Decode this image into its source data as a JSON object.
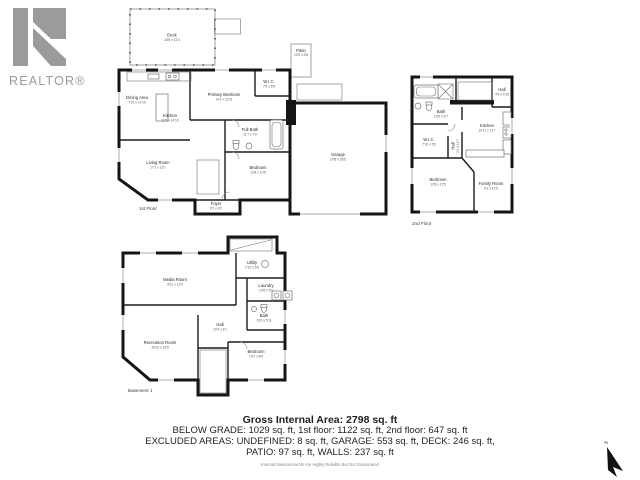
{
  "logo": {
    "brand": "REALTOR®"
  },
  "floors": {
    "first": {
      "label": "1st Floor",
      "rooms": {
        "deck": {
          "name": "Deck",
          "dims": "18'6 x 12'4"
        },
        "patio": {
          "name": "Patio",
          "dims": "10'0 x 5'8"
        },
        "dining": {
          "name": "Dining Area",
          "dims": "7'10 x 14'10"
        },
        "kitchen": {
          "name": "Kitchen",
          "dims": "11'5 x 14'10"
        },
        "living": {
          "name": "Living Room",
          "dims": "17'1 x 13'1"
        },
        "primary_bedroom": {
          "name": "Primary Bedroom",
          "dims": "14'2 x 10'11"
        },
        "wic": {
          "name": "W.I.C.",
          "dims": "7'6 x 5'6"
        },
        "full_bath": {
          "name": "Full Bath",
          "dims": "11'7 x 7'0"
        },
        "bedroom": {
          "name": "Bedroom",
          "dims": "12'8 x 10'5"
        },
        "foyer": {
          "name": "Foyer",
          "dims": "6'7 x 4'2"
        },
        "garage": {
          "name": "Garage",
          "dims": "20'8 x 26'5"
        }
      }
    },
    "second": {
      "label": "2nd Floor",
      "rooms": {
        "bath": {
          "name": "Bath",
          "dims": "13'6 x 5'7"
        },
        "hall_upper": {
          "name": "Hall",
          "dims": "4'9 x 4'10"
        },
        "kitchen": {
          "name": "Kitchen",
          "dims": "10'11 x 11'7"
        },
        "wic": {
          "name": "W.I.C.",
          "dims": "7'10 x 5'5"
        },
        "hall": {
          "name": "Hall",
          "dims": "3'1 x 11'7"
        },
        "bedroom": {
          "name": "Bedroom",
          "dims": "12'8 x 11'5"
        },
        "family": {
          "name": "Family Room",
          "dims": "9'2 x 11'5"
        }
      }
    },
    "basement": {
      "label": "Basement 1",
      "rooms": {
        "media": {
          "name": "Media Room",
          "dims": "25'1 x 12'0"
        },
        "utility": {
          "name": "Utility",
          "dims": "7'10 x 5'6"
        },
        "laundry": {
          "name": "Laundry",
          "dims": "10'6 x 5'0"
        },
        "bath": {
          "name": "Bath",
          "dims": "10'6 x 5'11"
        },
        "hall": {
          "name": "Hall",
          "dims": "10'4 x 8'1"
        },
        "recreation": {
          "name": "Recreation Room",
          "dims": "16'10 x 16'5"
        },
        "bedroom": {
          "name": "Bedroom",
          "dims": "14'2 x 8'9"
        }
      }
    }
  },
  "summary": {
    "title": "Gross Internal Area: 2798 sq. ft",
    "line1": "BELOW GRADE: 1029 sq. ft, 1st floor: 1122 sq. ft, 2nd floor: 647 sq. ft",
    "line2": "EXCLUDED AREAS: UNDEFINED: 8 sq. ft, GARAGE: 553 sq. ft, DECK: 246 sq. ft,",
    "line3": "PATIO: 97 sq. ft, WALLS: 237 sq. ft",
    "disclaimer": "Internal Measurements Are Highly Reliable But Not Guaranteed"
  },
  "compass": {
    "north_label": "N"
  },
  "colors": {
    "wall": "#151515",
    "logo_gray": "#9b9b9b",
    "text": "#1f1f1f"
  }
}
